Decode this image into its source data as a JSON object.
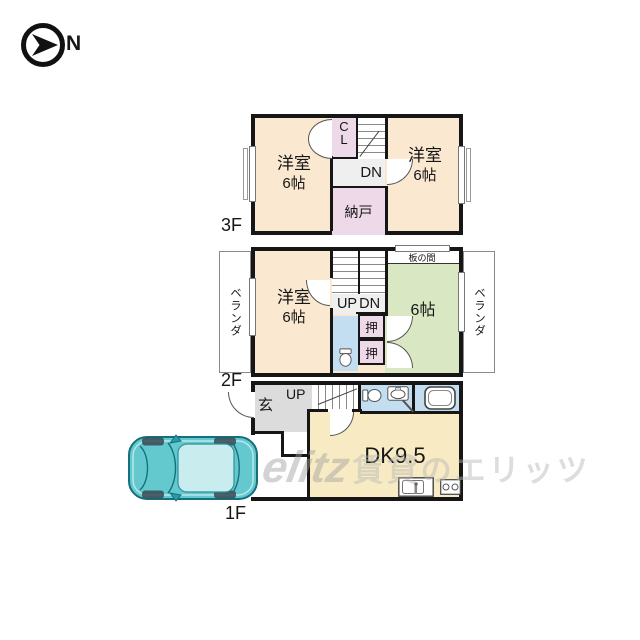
{
  "compass": {
    "north_label": "N"
  },
  "floor3": {
    "label": "3F",
    "left_room_name": "洋室",
    "left_room_size": "6帖",
    "closet": "CL",
    "stair_down": "DN",
    "storage": "納戸",
    "right_room_name": "洋室",
    "right_room_size": "6帖"
  },
  "floor2": {
    "label": "2F",
    "veranda_left": "ベランダ",
    "veranda_right": "ベランダ",
    "left_room_name": "洋室",
    "left_room_size": "6帖",
    "stair_up": "UP",
    "stair_down": "DN",
    "closet_upper": "押",
    "closet_lower": "押",
    "wood_floor_area": "板の間",
    "right_room_size": "6帖"
  },
  "floor1": {
    "label": "1F",
    "entrance": "玄",
    "stair_up": "UP",
    "dining_kitchen": "DK9.5"
  },
  "watermark": {
    "logo": "elitz",
    "brand": "賃貸のエリッツ"
  },
  "colors": {
    "room_peach": "#fbe8d1",
    "closet_pink": "#eed9e9",
    "tatami_green": "#d9e8c2",
    "dk_yellow": "#f8ebc3",
    "water_blue": "#c3def0",
    "hall_gray": "#dcdcdc",
    "wall_black": "#161616",
    "car_teal": "#64c9cf"
  }
}
